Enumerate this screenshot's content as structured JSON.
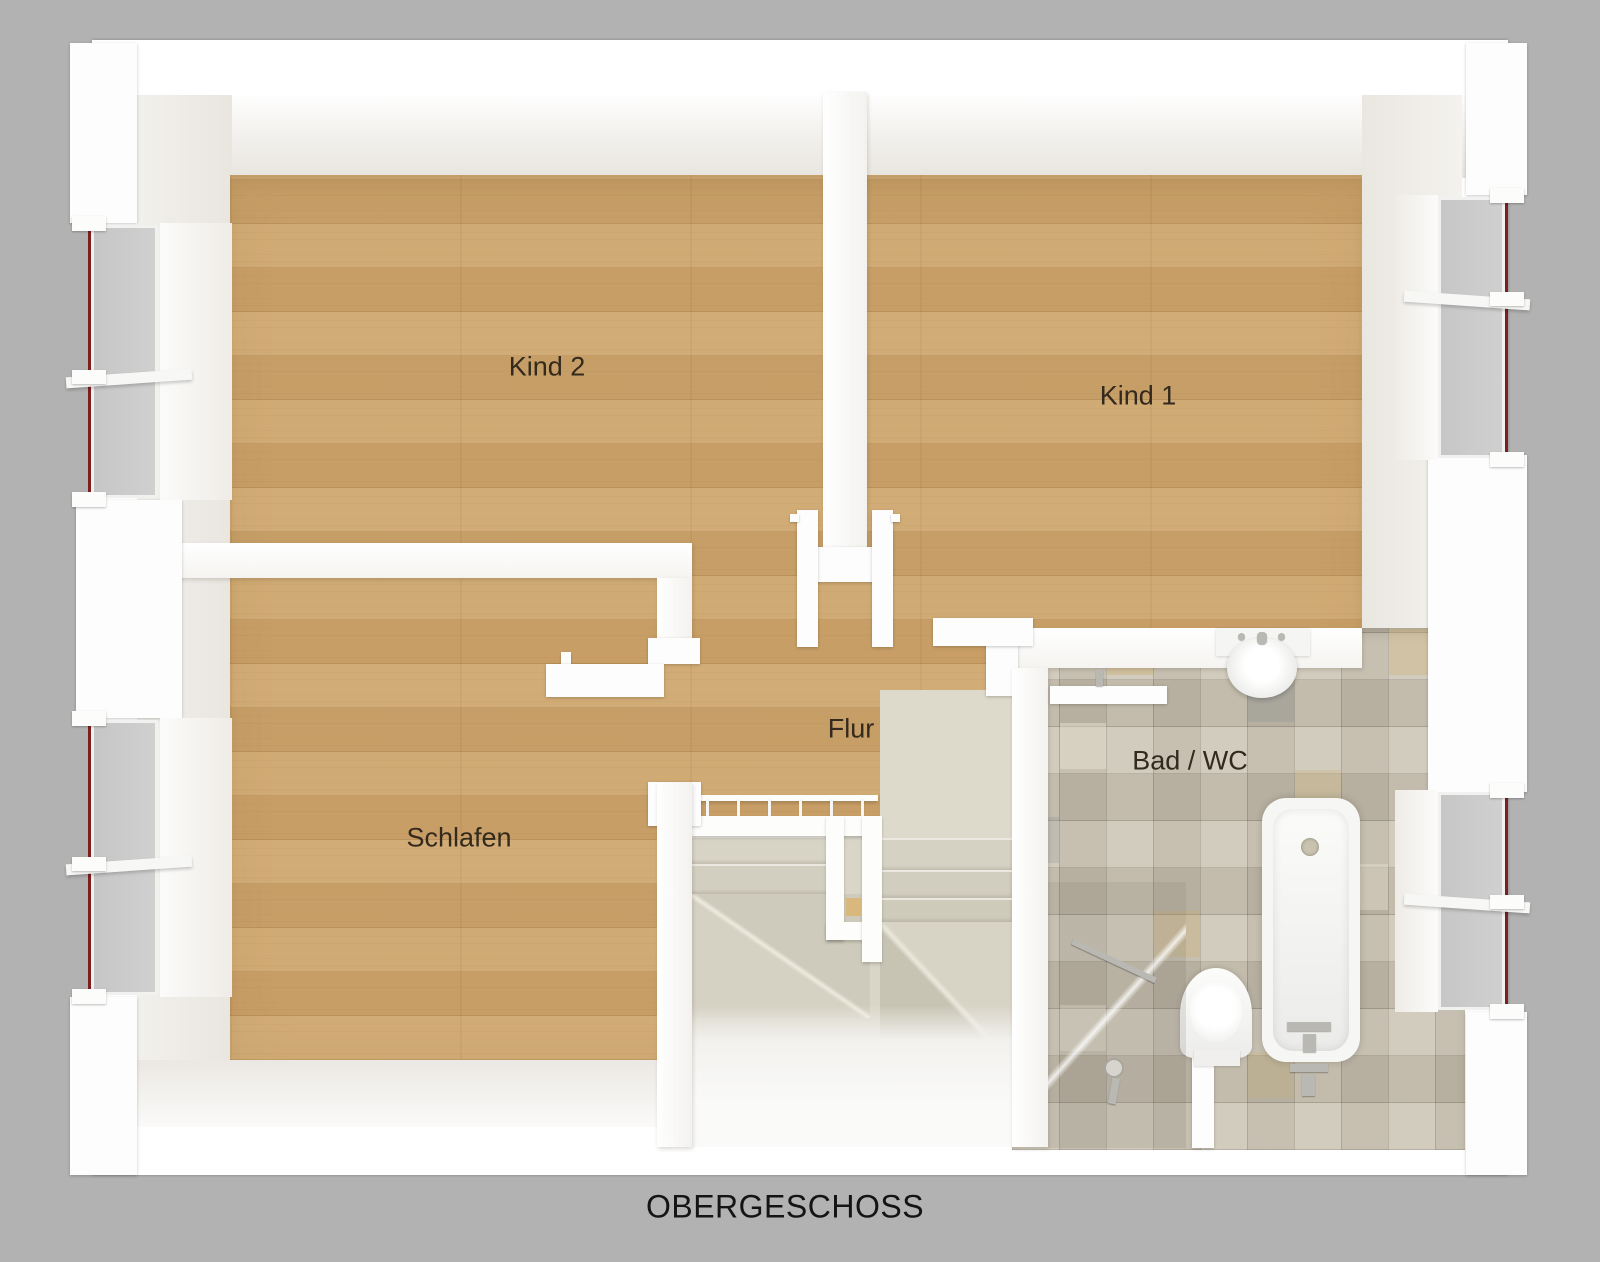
{
  "title": "OBERGESCHOSS",
  "rooms": [
    {
      "name": "Kind 2"
    },
    {
      "name": "Kind 1"
    },
    {
      "name": "Schlafen"
    },
    {
      "name": "Flur"
    },
    {
      "name": "Bad / WC"
    }
  ],
  "colors": {
    "background": "#b2b2b2",
    "wall": "#ffffff",
    "wood_floor": "#cda56c",
    "tile_floor": "#c7c0b1",
    "stair_stone": "#d9d5c7",
    "window_glazing_line": "#7c1f1f"
  }
}
